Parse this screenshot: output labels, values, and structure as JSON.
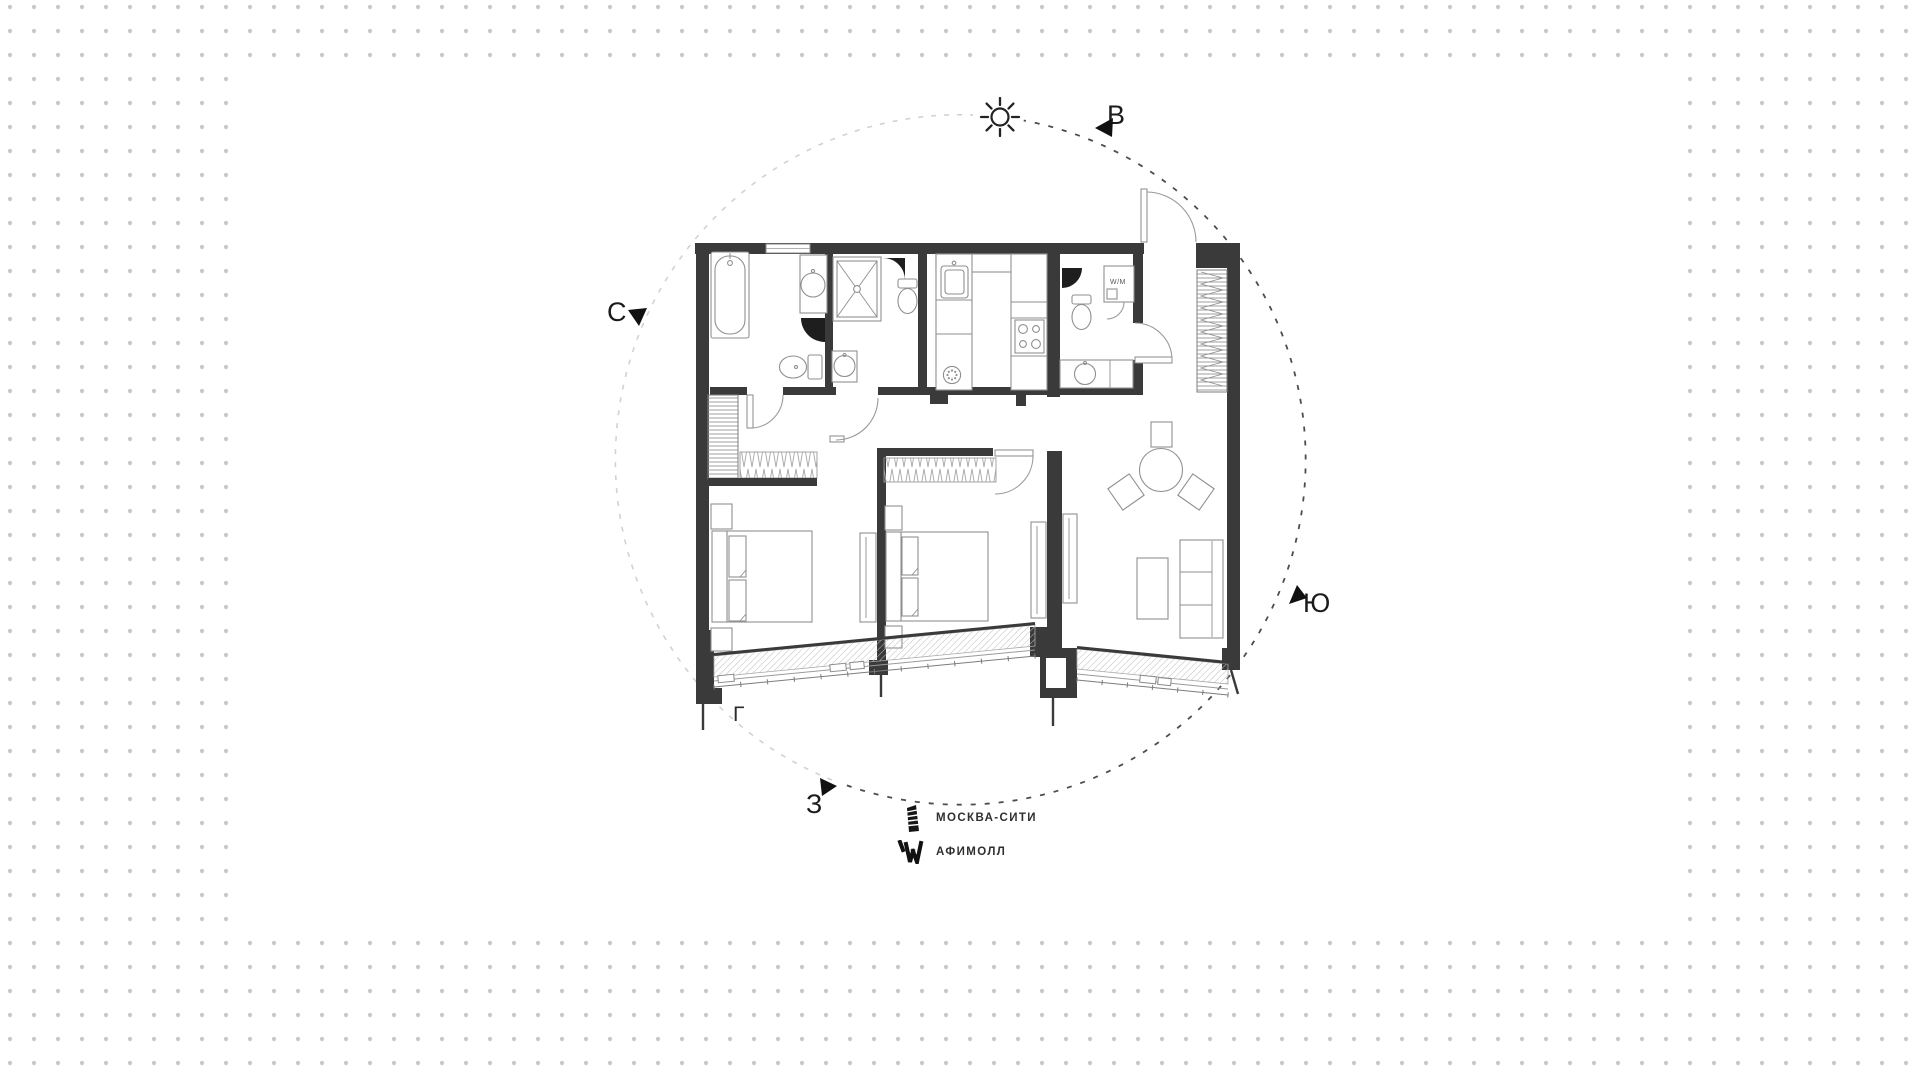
{
  "canvas": {
    "dot_color": "#c9c9c9",
    "card_color": "#ffffff",
    "wall_color": "#3a3a3a",
    "dark_dash_color": "#4d4d4d",
    "light_dash_color": "#d2d2d2"
  },
  "compass": {
    "north": "С",
    "east": "В",
    "south": "Ю",
    "west": "З"
  },
  "plan": {
    "washer_label": "W/M",
    "corner_mark": "Г"
  },
  "legend": {
    "items": [
      {
        "icon": "skyscraper-icon",
        "label": "МОСКВА-СИТИ"
      },
      {
        "icon": "afimall-icon",
        "label": "АФИМОЛЛ"
      }
    ]
  }
}
